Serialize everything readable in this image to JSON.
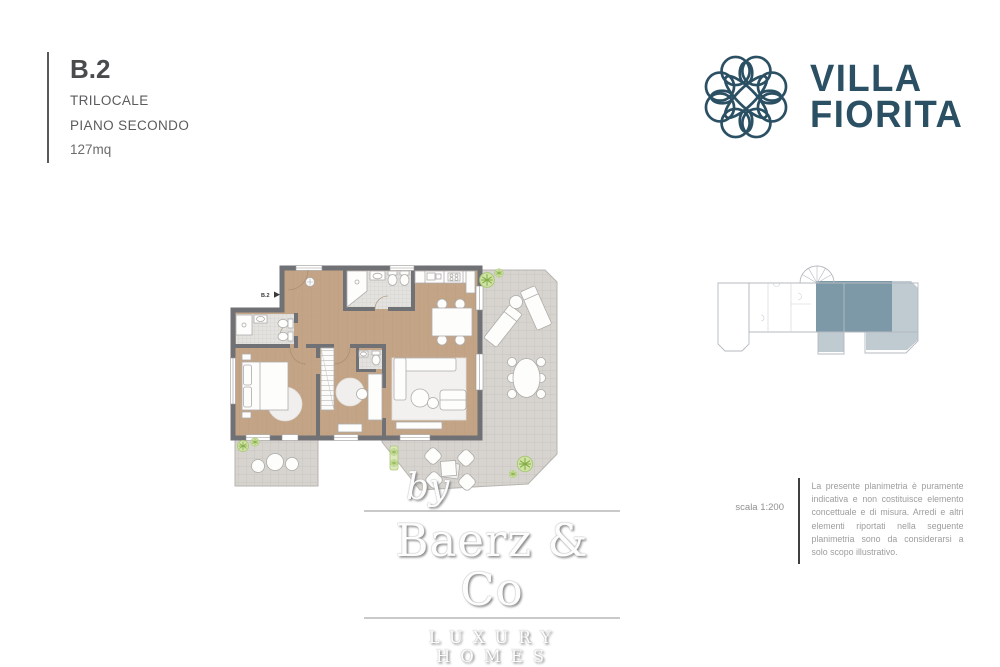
{
  "header": {
    "unit_code": "B.2",
    "unit_type": "TRILOCALE",
    "floor": "PIANO SECONDO",
    "area": "127mq"
  },
  "logo": {
    "icon": "flower-knot-icon",
    "name_line1": "VILLA",
    "name_line2": "FIORITA",
    "color": "#2b5064"
  },
  "floorplan": {
    "entrance_label": "B.2",
    "colors": {
      "wall": "#707174",
      "wood_floor": "#c3a486",
      "terrace_tile": "#d7d4d0",
      "bath_tile": "#e4e2de",
      "furniture": "#fdfdfc",
      "plant_green": "#cfe3a4",
      "rug": "#f2f1ef"
    }
  },
  "minimap": {
    "outline_color": "#b4bac1",
    "highlight_dark": "#73909f",
    "highlight_light": "#b8c5cc"
  },
  "notes": {
    "scale_label": "scala 1:200",
    "disclaimer": "La presente planimetria è puramente indicativa e non costituisce elemento concettuale e di misura. Arredi e altri elementi riportati nella seguente planimetria sono da considerarsi a solo scopo illustrativo."
  },
  "watermark": {
    "by_label": "by",
    "brand": "Baerz & Co",
    "tagline": "LUXURY HOMES"
  }
}
